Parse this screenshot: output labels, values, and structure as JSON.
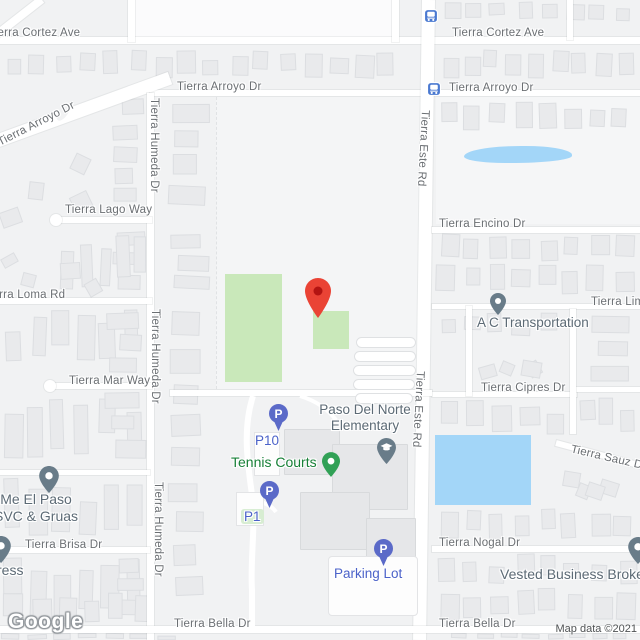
{
  "map": {
    "logo": "Google",
    "attribution": "Map data ©2021"
  },
  "streets": {
    "cortez": "Tierra Cortez Ave",
    "arroyo": "Tierra Arroyo Dr",
    "humeda": "Tierra Humeda Dr",
    "este": "Tierra Este Rd",
    "lago": "Tierra Lago Way",
    "loma": "Tierra Loma Rd",
    "mar": "Tierra Mar Way",
    "brisa": "Tierra Brisa Dr",
    "encino": "Tierra Encino Dr",
    "lim": "Tierra Lim",
    "cipres": "Tierra Cipres Dr",
    "sauz": "Tierra Sauz Dr",
    "nogal": "Tierra Nogal Dr",
    "bella": "Tierra Bella Dr"
  },
  "pois": {
    "ac_transportation": {
      "label": "A C Transportation"
    },
    "school": {
      "line1": "Paso Del Norte",
      "line2": "Elementary"
    },
    "tennis": {
      "label": "Tennis Courts"
    },
    "p10": {
      "label": "P10"
    },
    "p1": {
      "label": "P1"
    },
    "parking_lot": {
      "label": "Parking Lot"
    },
    "me_el_paso": {
      "line1": "Me El Paso",
      "line2": "SVC & Gruas"
    },
    "ress": {
      "label": "ress"
    },
    "vested": {
      "label": "Vested Business Broke"
    },
    "parking_glyph": "P"
  },
  "colors": {
    "destination_pin": "#EA4335",
    "destination_pin_inner": "#B31412",
    "poi_pin": "#697c89",
    "tennis_pin": "#31a156",
    "parking_pin": "#5b6ac8",
    "bus_icon": "#4a79d1",
    "park_green": "#c9e8ba",
    "water_blue": "#a3d6f8",
    "street_text": "#6b6f73",
    "poi_text": "#5c6a75",
    "green_text": "#188038",
    "blue_text": "#4b62c9"
  }
}
